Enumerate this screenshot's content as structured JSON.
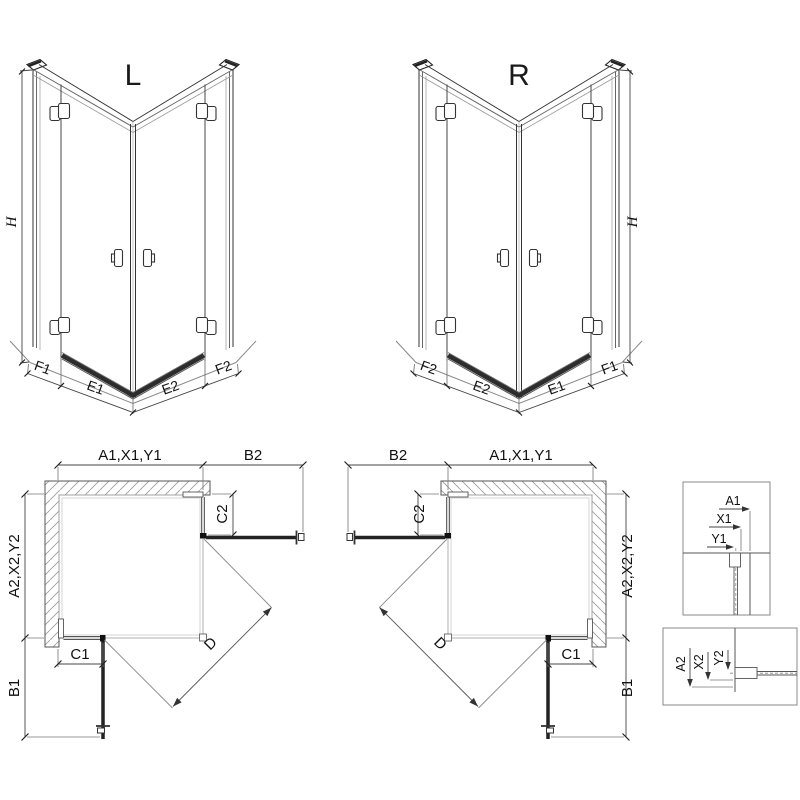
{
  "drawing": {
    "type": "shower-enclosure-technical-diagram",
    "background": "#ffffff",
    "line_color": "#333333"
  },
  "views": {
    "l3d": {
      "title": "L",
      "height": "H",
      "seg_f1": "F1",
      "seg_e1": "E1",
      "seg_e2": "E2",
      "seg_f2": "F2"
    },
    "r3d": {
      "title": "R",
      "height": "H",
      "seg_f1": "F1",
      "seg_e1": "E1",
      "seg_e2": "E2",
      "seg_f2": "F2"
    },
    "lplan": {
      "width_top": "A1,X1,Y1",
      "width_door": "B2",
      "depth_side": "A2,X2,Y2",
      "depth_door": "B1",
      "fixed_c1": "C1",
      "fixed_c2": "C2",
      "diagonal": "D"
    },
    "rplan": {
      "width_top": "A1,X1,Y1",
      "width_door": "B2",
      "depth_side": "A2,X2,Y2",
      "depth_door": "B1",
      "fixed_c1": "C1",
      "fixed_c2": "C2",
      "diagonal": "D"
    },
    "detail_h": {
      "dim1": "A1",
      "dim2": "X1",
      "dim3": "Y1"
    },
    "detail_v": {
      "dim1": "A2",
      "dim2": "X2",
      "dim3": "Y2"
    }
  }
}
